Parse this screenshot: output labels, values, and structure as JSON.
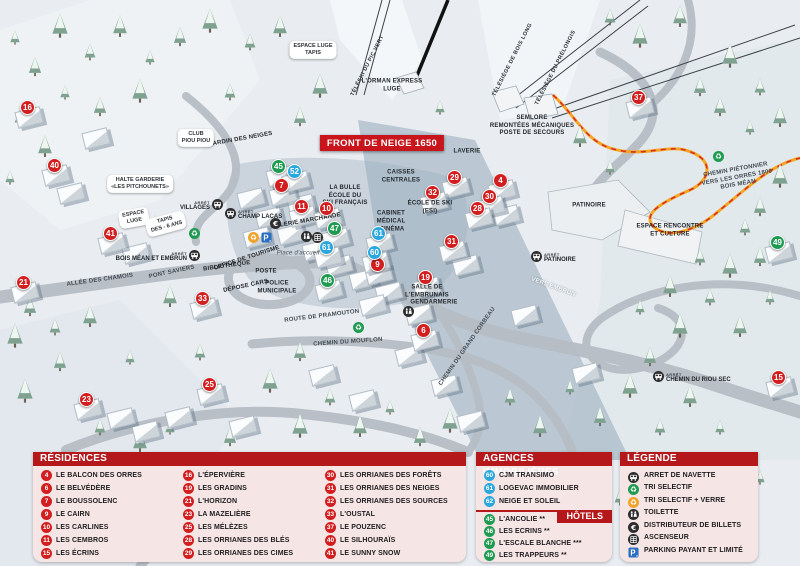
{
  "front_banner": {
    "text": "FRONT DE NEIGE 1650",
    "x": 382,
    "y": 143
  },
  "colors": {
    "marker_red": "#d21e1e",
    "marker_green": "#1e9b51",
    "marker_blue": "#2aa7dd",
    "header_red": "#b5181b",
    "banner_red": "#c8151b",
    "panel_pink": "#f6e5e5",
    "parking_blue": "#2a6fc0",
    "recycle_yellow": "#f0a22b",
    "icon_dark": "#2e2e2e"
  },
  "map": {
    "arret_label": "ARRÊT",
    "markers": [
      {
        "n": "16",
        "color": "red",
        "x": 28,
        "y": 108
      },
      {
        "n": "40",
        "color": "red",
        "x": 55,
        "y": 166
      },
      {
        "n": "41",
        "color": "red",
        "x": 111,
        "y": 234
      },
      {
        "n": "21",
        "color": "red",
        "x": 24,
        "y": 283
      },
      {
        "n": "33",
        "color": "red",
        "x": 203,
        "y": 299
      },
      {
        "n": "23",
        "color": "red",
        "x": 87,
        "y": 400
      },
      {
        "n": "25",
        "color": "red",
        "x": 210,
        "y": 385
      },
      {
        "n": "7",
        "color": "red",
        "x": 282,
        "y": 186
      },
      {
        "n": "11",
        "color": "red",
        "x": 302,
        "y": 207
      },
      {
        "n": "10",
        "color": "red",
        "x": 327,
        "y": 209
      },
      {
        "n": "9",
        "color": "red",
        "x": 378,
        "y": 265
      },
      {
        "n": "29",
        "color": "red",
        "x": 455,
        "y": 178
      },
      {
        "n": "32",
        "color": "red",
        "x": 433,
        "y": 193
      },
      {
        "n": "4",
        "color": "red",
        "x": 501,
        "y": 181
      },
      {
        "n": "30",
        "color": "red",
        "x": 490,
        "y": 197
      },
      {
        "n": "28",
        "color": "red",
        "x": 478,
        "y": 209
      },
      {
        "n": "31",
        "color": "red",
        "x": 452,
        "y": 242
      },
      {
        "n": "19",
        "color": "red",
        "x": 426,
        "y": 278
      },
      {
        "n": "6",
        "color": "red",
        "x": 424,
        "y": 331
      },
      {
        "n": "37",
        "color": "red",
        "x": 639,
        "y": 98
      },
      {
        "n": "15",
        "color": "red",
        "x": 779,
        "y": 378
      },
      {
        "n": "45",
        "color": "green",
        "x": 279,
        "y": 167
      },
      {
        "n": "47",
        "color": "green",
        "x": 335,
        "y": 229
      },
      {
        "n": "46",
        "color": "green",
        "x": 328,
        "y": 281
      },
      {
        "n": "49",
        "color": "green",
        "x": 778,
        "y": 243
      },
      {
        "n": "52",
        "color": "blue",
        "x": 295,
        "y": 172
      },
      {
        "n": "61",
        "color": "blue",
        "x": 379,
        "y": 234
      },
      {
        "n": "61",
        "color": "blue",
        "x": 327,
        "y": 248
      },
      {
        "n": "60",
        "color": "blue",
        "x": 375,
        "y": 253
      }
    ],
    "bus_stops": [
      {
        "name": "VILLAGES",
        "x": 216,
        "y": 206,
        "side": "left"
      },
      {
        "name": "CHAMP LACAS",
        "x": 232,
        "y": 215,
        "side": "right"
      },
      {
        "name": "BOIS MÉAN ET EMBRUN",
        "x": 193,
        "y": 257,
        "side": "left"
      },
      {
        "name": "PATINOIRE",
        "x": 538,
        "y": 258,
        "side": "right"
      },
      {
        "name": "CHEMIN DU RIOU SEC",
        "x": 660,
        "y": 378,
        "side": "right"
      }
    ],
    "icons": [
      {
        "type": "recycle-green",
        "x": 194,
        "y": 233
      },
      {
        "type": "recycle-green",
        "x": 358,
        "y": 327
      },
      {
        "type": "recycle-green",
        "x": 718,
        "y": 156
      },
      {
        "type": "recycle-yellow",
        "x": 253,
        "y": 237
      },
      {
        "type": "parking",
        "x": 266,
        "y": 237
      },
      {
        "type": "euro",
        "x": 275,
        "y": 223
      },
      {
        "type": "wc",
        "x": 306,
        "y": 236
      },
      {
        "type": "elevator",
        "x": 317,
        "y": 237
      },
      {
        "type": "wc",
        "x": 408,
        "y": 311
      }
    ],
    "labels": [
      {
        "text": "TÉLÉSKI DU PIC VERT",
        "x": 368,
        "y": 66,
        "rot": -63,
        "cls": "lift"
      },
      {
        "text": "TÉLÉSIÈGE DE BOIS LONG",
        "x": 513,
        "y": 60,
        "rot": -63,
        "cls": "lift"
      },
      {
        "text": "TÉLÉSIÈGE DU PRÉLONGIS",
        "x": 556,
        "y": 68,
        "rot": -63,
        "cls": "lift"
      },
      {
        "text": "L'ORMAN EXPRESS\nLUGE",
        "x": 392,
        "y": 86,
        "rot": 0,
        "cls": "poi"
      },
      {
        "text": "SEMLORE\nREMONTÉES MÉCANIQUES\nPOSTE DE SECOURS",
        "x": 532,
        "y": 126,
        "rot": 0,
        "cls": "poi"
      },
      {
        "text": "LAVERIE",
        "x": 467,
        "y": 152,
        "rot": 0,
        "cls": "poi"
      },
      {
        "text": "CAISSES\nCENTRALES",
        "x": 401,
        "y": 177,
        "rot": 0,
        "cls": "poi"
      },
      {
        "text": "LA BULLE\nÉCOLE DU\nSKI FRANÇAIS",
        "x": 345,
        "y": 196,
        "rot": 0,
        "cls": "poi"
      },
      {
        "text": "ÉCOLE DE SKI\n(ESI)",
        "x": 430,
        "y": 208,
        "rot": 0,
        "cls": "poi"
      },
      {
        "text": "CABINET\nMÉDICAL",
        "x": 391,
        "y": 218,
        "rot": 0,
        "cls": "poi"
      },
      {
        "text": "CINÉMA",
        "x": 392,
        "y": 230,
        "rot": 0,
        "cls": "poi"
      },
      {
        "text": "GALERIE MARCHANDE",
        "x": 306,
        "y": 222,
        "rot": -10,
        "cls": "poi"
      },
      {
        "text": "JARDIN DES NEIGES",
        "x": 241,
        "y": 140,
        "rot": -10,
        "cls": "poi"
      },
      {
        "text": "PONT SAVIERS",
        "x": 172,
        "y": 273,
        "rot": -12,
        "cls": "road"
      },
      {
        "text": "ALLÉE DES CHAMOIS",
        "x": 100,
        "y": 281,
        "rot": -8,
        "cls": "road"
      },
      {
        "text": "OFFICE DE TOURISME",
        "x": 247,
        "y": 259,
        "rot": -18,
        "cls": "poi"
      },
      {
        "text": "BIBLIOTHÈQUE",
        "x": 227,
        "y": 267,
        "rot": -8,
        "cls": "poi"
      },
      {
        "text": "POSTE",
        "x": 266,
        "y": 272,
        "rot": 0,
        "cls": "poi"
      },
      {
        "text": "DÉPOSE CARS",
        "x": 246,
        "y": 287,
        "rot": -12,
        "cls": "poi"
      },
      {
        "text": "POLICE\nMUNICIPALE",
        "x": 277,
        "y": 288,
        "rot": 0,
        "cls": "poi"
      },
      {
        "text": "Place d'accueil",
        "x": 298,
        "y": 254,
        "rot": 0,
        "cls": "place"
      },
      {
        "text": "ROUTE DE PRAMOUTON",
        "x": 322,
        "y": 317,
        "rot": -7,
        "cls": "road"
      },
      {
        "text": "CHEMIN DU MOUFLON",
        "x": 348,
        "y": 343,
        "rot": -4,
        "cls": "road"
      },
      {
        "text": "CHEMIN DU GRAND CORBEAU",
        "x": 468,
        "y": 347,
        "rot": -55,
        "cls": "road"
      },
      {
        "text": "SALLE DE\nL'EMBRUNAIS",
        "x": 427,
        "y": 292,
        "rot": 0,
        "cls": "poi"
      },
      {
        "text": "GENDARMERIE",
        "x": 434,
        "y": 303,
        "rot": 0,
        "cls": "poi"
      },
      {
        "text": "PATINOIRE",
        "x": 589,
        "y": 206,
        "rot": 0,
        "cls": "poi"
      },
      {
        "text": "ESPACE RENCONTRE\nET CULTURE",
        "x": 670,
        "y": 231,
        "rot": 0,
        "cls": "poi"
      },
      {
        "text": "VERS EMBRUN",
        "x": 553,
        "y": 288,
        "rot": 20,
        "cls": "white"
      },
      {
        "text": "CHEMIN PIÉTONNIER\nVERS LES ORRES 1800\nBOIS MÉAN",
        "x": 737,
        "y": 178,
        "rot": -10,
        "cls": "road"
      }
    ],
    "clouds": [
      {
        "text": "CLUB\nPIOU PIOU",
        "x": 196,
        "y": 138,
        "rot": 0
      },
      {
        "text": "HALTE GARDERIE\n«LES PITCHOUNETS»",
        "x": 140,
        "y": 184,
        "rot": 0
      },
      {
        "text": "ESPACE\nLUGE",
        "x": 134,
        "y": 218,
        "rot": -10
      },
      {
        "text": "TAPIS\nDES - 6 ANS",
        "x": 166,
        "y": 224,
        "rot": -15
      },
      {
        "text": "ESPACE LUGE\nTAPIS",
        "x": 313,
        "y": 50,
        "rot": 0
      }
    ]
  },
  "legend_panel": {
    "residences": {
      "header": "RÉSIDENCES",
      "columns": [
        [
          {
            "n": "4",
            "name": "LE BALCON DES ORRES"
          },
          {
            "n": "6",
            "name": "LE BELVÉDÈRE"
          },
          {
            "n": "7",
            "name": "LE BOUSSOLENC"
          },
          {
            "n": "9",
            "name": "LE CAIRN"
          },
          {
            "n": "10",
            "name": "LES CARLINES"
          },
          {
            "n": "11",
            "name": "LES CEMBROS"
          },
          {
            "n": "15",
            "name": "LES ÉCRINS"
          }
        ],
        [
          {
            "n": "16",
            "name": "L'ÉPERVIÈRE"
          },
          {
            "n": "19",
            "name": "LES GRADINS"
          },
          {
            "n": "21",
            "name": "L'HORIZON"
          },
          {
            "n": "23",
            "name": "LA MAZELIÈRE"
          },
          {
            "n": "25",
            "name": "LES MÉLÈZES"
          },
          {
            "n": "28",
            "name": "LES ORRIANES DES BLÉS"
          },
          {
            "n": "29",
            "name": "LES ORRIANES DES CIMES"
          }
        ],
        [
          {
            "n": "30",
            "name": "LES ORRIANES DES FORÊTS"
          },
          {
            "n": "31",
            "name": "LES ORRIANES DES NEIGES"
          },
          {
            "n": "32",
            "name": "LES ORRIANES DES SOURCES"
          },
          {
            "n": "33",
            "name": "L'OUSTAL"
          },
          {
            "n": "37",
            "name": "LE POUZENC"
          },
          {
            "n": "40",
            "name": "LE SILHOURAÏS"
          },
          {
            "n": "41",
            "name": "LE SUNNY SNOW"
          }
        ]
      ]
    },
    "agences": {
      "header": "AGENCES IMMOBILIÈRES",
      "items": [
        {
          "n": "60",
          "name": "CJM TRANSIMO"
        },
        {
          "n": "61",
          "name": "LOGEVAC IMMOBILIER"
        },
        {
          "n": "62",
          "name": "NEIGE ET SOLEIL"
        }
      ]
    },
    "hotels": {
      "header": "HÔTELS",
      "items": [
        {
          "n": "45",
          "name": "L'ANCOLIE **"
        },
        {
          "n": "46",
          "name": "LES ECRINS **"
        },
        {
          "n": "47",
          "name": "L'ESCALE BLANCHE ***"
        },
        {
          "n": "49",
          "name": "LES TRAPPEURS **"
        }
      ]
    },
    "legende": {
      "header": "LÉGENDE",
      "items": [
        {
          "icon": "bus",
          "label": "ARRET DE NAVETTE"
        },
        {
          "icon": "recycle-green",
          "label": "TRI SELECTIF"
        },
        {
          "icon": "recycle-yellow",
          "label": "TRI SELECTIF + VERRE"
        },
        {
          "icon": "wc",
          "label": "TOILETTE"
        },
        {
          "icon": "euro",
          "label": "DISTRIBUTEUR DE BILLETS"
        },
        {
          "icon": "elevator",
          "label": "ASCENSEUR"
        },
        {
          "icon": "parking",
          "label": "PARKING PAYANT ET LIMITÉ"
        }
      ]
    }
  }
}
